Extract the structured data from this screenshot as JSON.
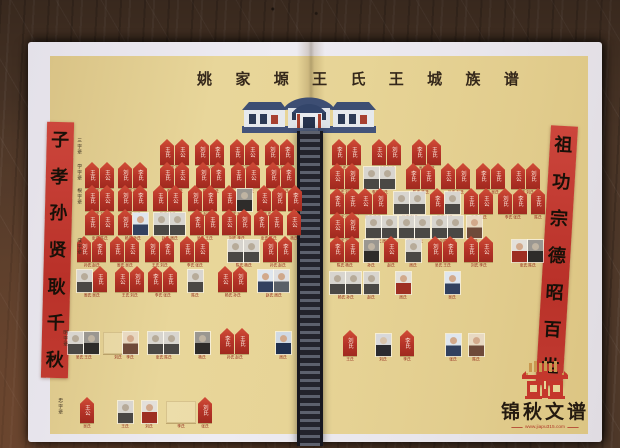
{
  "title": {
    "text": "姚家塬王氏王城族谱"
  },
  "banners": {
    "left": "子孝孙贤耿千秋",
    "right": "祖功宗德昭百世"
  },
  "publisher": {
    "name": "锦秋文谱",
    "url": "www.jiapu315.com"
  },
  "colors": {
    "tablet_red": "#b43327",
    "banner_red": "#c23a31",
    "paper_white": "#e9e6ed",
    "print_background": "#e6d295",
    "wood_brown": "#4e3829",
    "ladder_dark": "#23232c",
    "roof_navy": "#3d4e73",
    "logo_red": "#c5372c",
    "logo_gold": "#c9984f"
  },
  "generation_labels": [
    {
      "text": "三字辈",
      "x": 76,
      "y": 138
    },
    {
      "text": "学字辈",
      "x": 76,
      "y": 164
    },
    {
      "text": "根字辈",
      "x": 76,
      "y": 188
    },
    {
      "text": "成字辈",
      "x": 76,
      "y": 238
    },
    {
      "text": "明字辈",
      "x": 62,
      "y": 330
    },
    {
      "text": "忠字辈",
      "x": 57,
      "y": 398
    }
  ],
  "tablet_glyphs": [
    "王氏",
    "王公",
    "刘氏",
    "李氏"
  ],
  "name_pool": [
    "王氏",
    "刘氏",
    "李氏",
    "张氏",
    "陈氏",
    "杨氏",
    "孙氏",
    "赵氏",
    "周氏",
    "吴氏"
  ],
  "pages": {
    "left": {
      "rows": [
        {
          "y": 139,
          "units": [
            {
              "x": 160,
              "c": [
                "t",
                "t"
              ]
            },
            {
              "x": 195,
              "c": [
                "t",
                "t"
              ]
            },
            {
              "x": 230,
              "c": [
                "t",
                "t"
              ]
            },
            {
              "x": 265,
              "c": [
                "t",
                "t"
              ]
            }
          ]
        },
        {
          "y": 162,
          "units": [
            {
              "x": 85,
              "c": [
                "t",
                "t"
              ]
            },
            {
              "x": 118,
              "c": [
                "t",
                "t"
              ]
            },
            {
              "x": 160,
              "c": [
                "t",
                "t"
              ]
            },
            {
              "x": 196,
              "c": [
                "t",
                "t"
              ]
            },
            {
              "x": 231,
              "c": [
                "t",
                "t"
              ]
            },
            {
              "x": 266,
              "c": [
                "t",
                "t"
              ]
            }
          ]
        },
        {
          "y": 185,
          "units": [
            {
              "x": 85,
              "c": [
                "t",
                "t"
              ]
            },
            {
              "x": 118,
              "c": [
                "t",
                "t"
              ]
            },
            {
              "x": 153,
              "c": [
                "t",
                "t"
              ]
            },
            {
              "x": 188,
              "c": [
                "t",
                "t"
              ]
            },
            {
              "x": 222,
              "c": [
                "t",
                "p:bwd"
              ]
            },
            {
              "x": 257,
              "c": [
                "t",
                "t"
              ]
            },
            {
              "x": 288,
              "c": [
                "t"
              ]
            }
          ]
        },
        {
          "y": 209,
          "units": [
            {
              "x": 85,
              "c": [
                "t",
                "t"
              ]
            },
            {
              "x": 118,
              "c": [
                "t",
                "p:cblue"
              ]
            },
            {
              "x": 154,
              "c": [
                "p:bw",
                "p:bw"
              ]
            },
            {
              "x": 190,
              "c": [
                "t",
                "t"
              ]
            },
            {
              "x": 222,
              "c": [
                "t",
                "t"
              ]
            },
            {
              "x": 254,
              "c": [
                "t",
                "t"
              ]
            },
            {
              "x": 287,
              "c": [
                "t"
              ]
            }
          ]
        },
        {
          "y": 236,
          "units": [
            {
              "x": 77,
              "c": [
                "t",
                "t"
              ]
            },
            {
              "x": 110,
              "c": [
                "t",
                "t"
              ]
            },
            {
              "x": 145,
              "c": [
                "t",
                "t"
              ]
            },
            {
              "x": 180,
              "c": [
                "t",
                "t"
              ]
            },
            {
              "x": 228,
              "c": [
                "p:bw",
                "p:bw"
              ]
            },
            {
              "x": 263,
              "c": [
                "t",
                "t"
              ]
            }
          ]
        },
        {
          "y": 266,
          "units": [
            {
              "x": 77,
              "c": [
                "p:bw",
                "t"
              ]
            },
            {
              "x": 115,
              "c": [
                "t",
                "t"
              ]
            },
            {
              "x": 148,
              "c": [
                "t",
                "t"
              ]
            },
            {
              "x": 188,
              "c": [
                "p:bw"
              ]
            },
            {
              "x": 218,
              "c": [
                "t",
                "t"
              ]
            },
            {
              "x": 258,
              "c": [
                "p:cblue",
                "p:cgray"
              ]
            }
          ]
        },
        {
          "y": 328,
          "units": [
            {
              "x": 68,
              "c": [
                "p:bw",
                "p:bwd"
              ]
            },
            {
              "x": 103,
              "c": [
                "e"
              ]
            },
            {
              "x": 123,
              "c": [
                "p:cwarm"
              ]
            },
            {
              "x": 148,
              "c": [
                "p:bw",
                "p:bw"
              ]
            },
            {
              "x": 195,
              "c": [
                "p:bwd"
              ]
            },
            {
              "x": 220,
              "c": [
                "t",
                "t"
              ]
            },
            {
              "x": 276,
              "c": [
                "p:csuit"
              ]
            }
          ]
        },
        {
          "y": 397,
          "units": [
            {
              "x": 80,
              "c": [
                "t"
              ]
            },
            {
              "x": 118,
              "c": [
                "p:bw"
              ]
            },
            {
              "x": 142,
              "c": [
                "p:cred"
              ]
            },
            {
              "x": 166,
              "c": [
                "e"
              ]
            },
            {
              "x": 198,
              "c": [
                "t"
              ]
            }
          ]
        }
      ]
    },
    "right": {
      "rows": [
        {
          "y": 139,
          "units": [
            {
              "x": 332,
              "c": [
                "t",
                "t"
              ]
            },
            {
              "x": 372,
              "c": [
                "t",
                "t"
              ]
            },
            {
              "x": 412,
              "c": [
                "t",
                "t"
              ]
            }
          ]
        },
        {
          "y": 163,
          "units": [
            {
              "x": 330,
              "c": [
                "t",
                "t"
              ]
            },
            {
              "x": 364,
              "c": [
                "p:bw",
                "p:bw"
              ]
            },
            {
              "x": 406,
              "c": [
                "t",
                "t"
              ]
            },
            {
              "x": 441,
              "c": [
                "t",
                "t"
              ]
            },
            {
              "x": 476,
              "c": [
                "t",
                "t"
              ]
            },
            {
              "x": 511,
              "c": [
                "t",
                "t"
              ]
            }
          ]
        },
        {
          "y": 188,
          "units": [
            {
              "x": 330,
              "c": [
                "t",
                "t"
              ]
            },
            {
              "x": 358,
              "c": [
                "t",
                "t"
              ]
            },
            {
              "x": 394,
              "c": [
                "p:bw",
                "p:bw"
              ]
            },
            {
              "x": 430,
              "c": [
                "t",
                "p:bw"
              ]
            },
            {
              "x": 464,
              "c": [
                "t",
                "t"
              ]
            },
            {
              "x": 498,
              "c": [
                "t",
                "t"
              ]
            },
            {
              "x": 531,
              "c": [
                "t"
              ]
            }
          ]
        },
        {
          "y": 212,
          "units": [
            {
              "x": 330,
              "c": [
                "t",
                "t"
              ]
            },
            {
              "x": 366,
              "c": [
                "p:bw",
                "p:bw"
              ]
            },
            {
              "x": 399,
              "c": [
                "p:bw",
                "p:bw"
              ]
            },
            {
              "x": 432,
              "c": [
                "p:bw",
                "p:bw"
              ]
            },
            {
              "x": 467,
              "c": [
                "p:cwarm"
              ]
            }
          ]
        },
        {
          "y": 236,
          "units": [
            {
              "x": 330,
              "c": [
                "t",
                "t"
              ]
            },
            {
              "x": 364,
              "c": [
                "p:bwd"
              ]
            },
            {
              "x": 384,
              "c": [
                "t"
              ]
            },
            {
              "x": 406,
              "c": [
                "p:bw"
              ]
            },
            {
              "x": 428,
              "c": [
                "t",
                "t"
              ]
            },
            {
              "x": 464,
              "c": [
                "t",
                "t"
              ]
            },
            {
              "x": 512,
              "c": [
                "p:cred",
                "p:bwd"
              ]
            }
          ]
        },
        {
          "y": 268,
          "units": [
            {
              "x": 330,
              "c": [
                "p:bw",
                "p:bw"
              ]
            },
            {
              "x": 364,
              "c": [
                "p:bw"
              ]
            },
            {
              "x": 396,
              "c": [
                "p:cred"
              ]
            },
            {
              "x": 445,
              "c": [
                "p:cblue"
              ]
            }
          ]
        },
        {
          "y": 330,
          "units": [
            {
              "x": 343,
              "c": [
                "t"
              ]
            },
            {
              "x": 376,
              "c": [
                "p:cdark"
              ]
            },
            {
              "x": 400,
              "c": [
                "t"
              ]
            },
            {
              "x": 446,
              "c": [
                "p:cblue"
              ]
            },
            {
              "x": 469,
              "c": [
                "p:cwarm"
              ]
            }
          ]
        }
      ]
    }
  }
}
